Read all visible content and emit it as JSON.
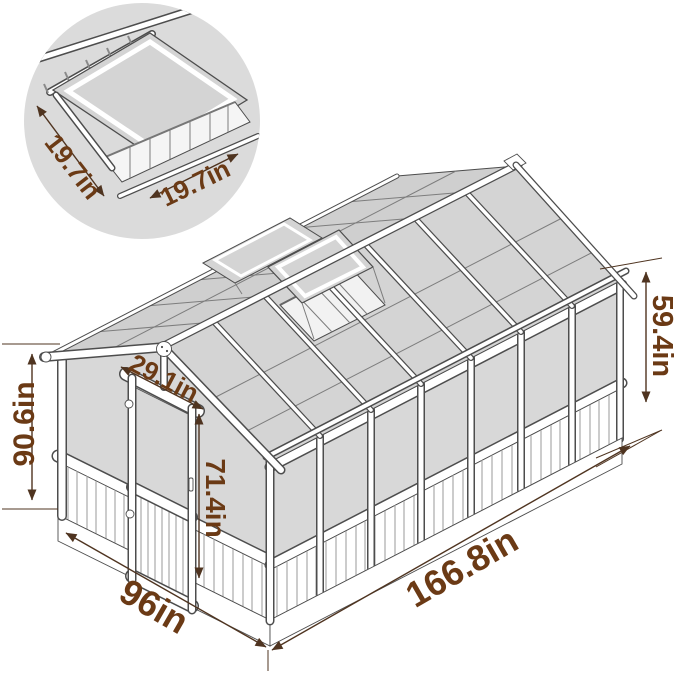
{
  "detail_inset": {
    "vent_width_label": "19.7in",
    "vent_length_label": "19.7in"
  },
  "dimensions": {
    "total_height": "90.6in",
    "eave_height": "59.4in",
    "side_length": "166.8in",
    "front_width": "96in",
    "door_width": "29.1in",
    "door_height": "71.4in"
  },
  "colors": {
    "dimension_text": "#6b3a15",
    "dimension_line": "#4f3420",
    "panel_grey": "#d8d8d8",
    "line_art": "#4d4d4d",
    "detail_circle_bg": "#dbdbdb",
    "background": "#ffffff"
  }
}
